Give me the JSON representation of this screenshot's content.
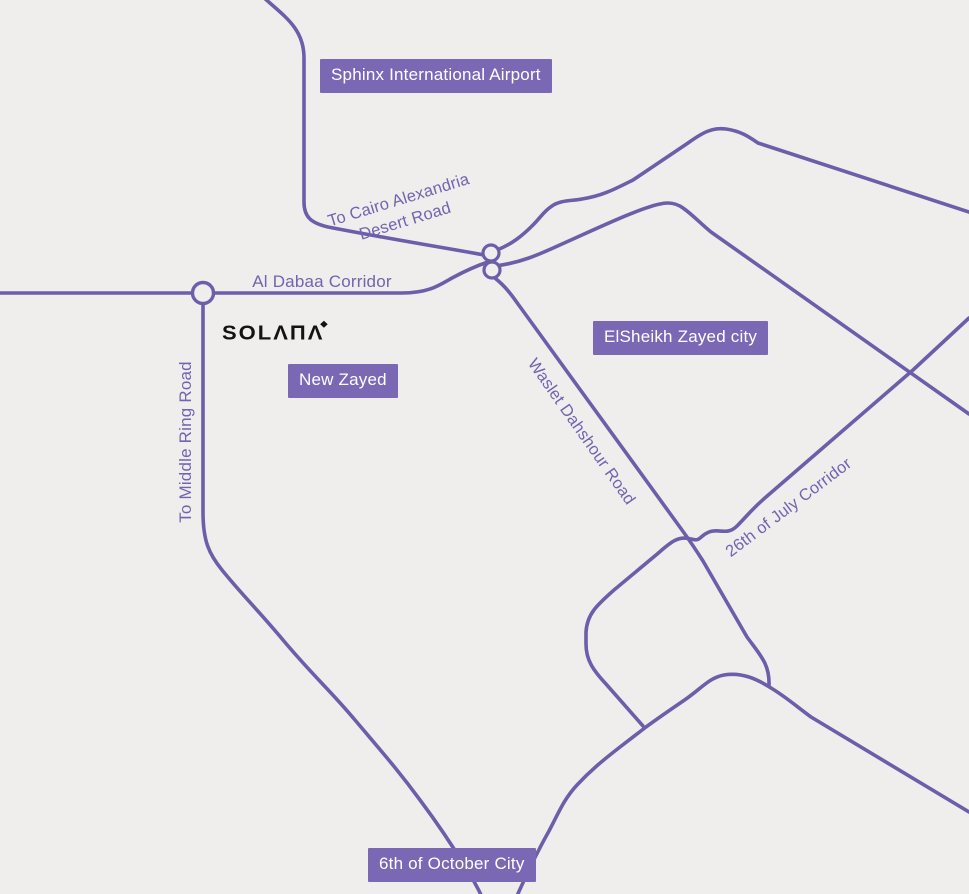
{
  "theme": {
    "background": "#efeeed",
    "road_color": "#6c5ea9",
    "place_label_bg": "#7a68b5",
    "place_label_text": "#ffffff",
    "road_label_color": "#7164b0",
    "brand_color": "#131313"
  },
  "brand": {
    "name": "SOLANA",
    "display": "SOLΛПΛ",
    "mark": "◆"
  },
  "place_labels": {
    "sphinx_airport": "Sphinx International Airport",
    "elsheikh_zayed": "ElSheikh Zayed city",
    "new_zayed": "New Zayed",
    "october_city": "6th of October City"
  },
  "road_labels": {
    "cairo_alex_line1": "To Cairo Alexandria",
    "cairo_alex_line2": "Desert Road",
    "al_dabaa": "Al Dabaa Corridor",
    "middle_ring": "To Middle Ring Road",
    "waslet_dahshour": "Waslet Dahshour Road",
    "july_corridor": "26th of July Corridor"
  }
}
